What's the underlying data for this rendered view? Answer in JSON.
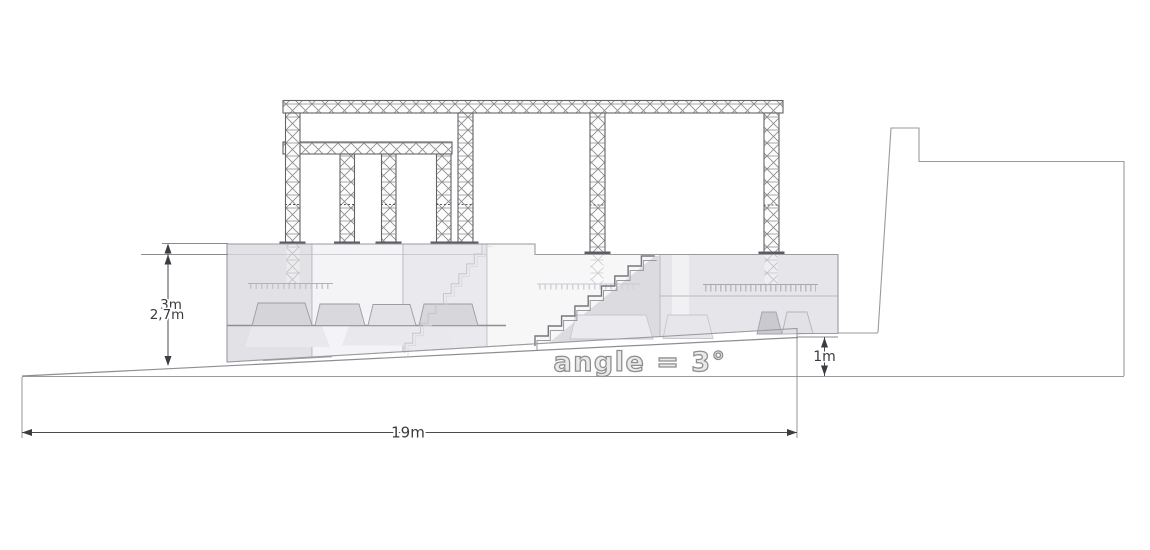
{
  "diagram": {
    "type": "stage-side-elevation-drawing",
    "labels": {
      "total_height": "3m",
      "stage_height": "2,7m",
      "platform_step_height": "1m",
      "total_length": "19m",
      "ramp_angle": "angle = 3°"
    },
    "colors": {
      "background": "#ffffff",
      "cad_line": "#9a9aa0",
      "dimension_text": "#3a3a40",
      "platform_fill": "#ececef",
      "angle_text_fill": "#e9e9e9",
      "angle_text_outline": "#8f8f8f"
    }
  }
}
